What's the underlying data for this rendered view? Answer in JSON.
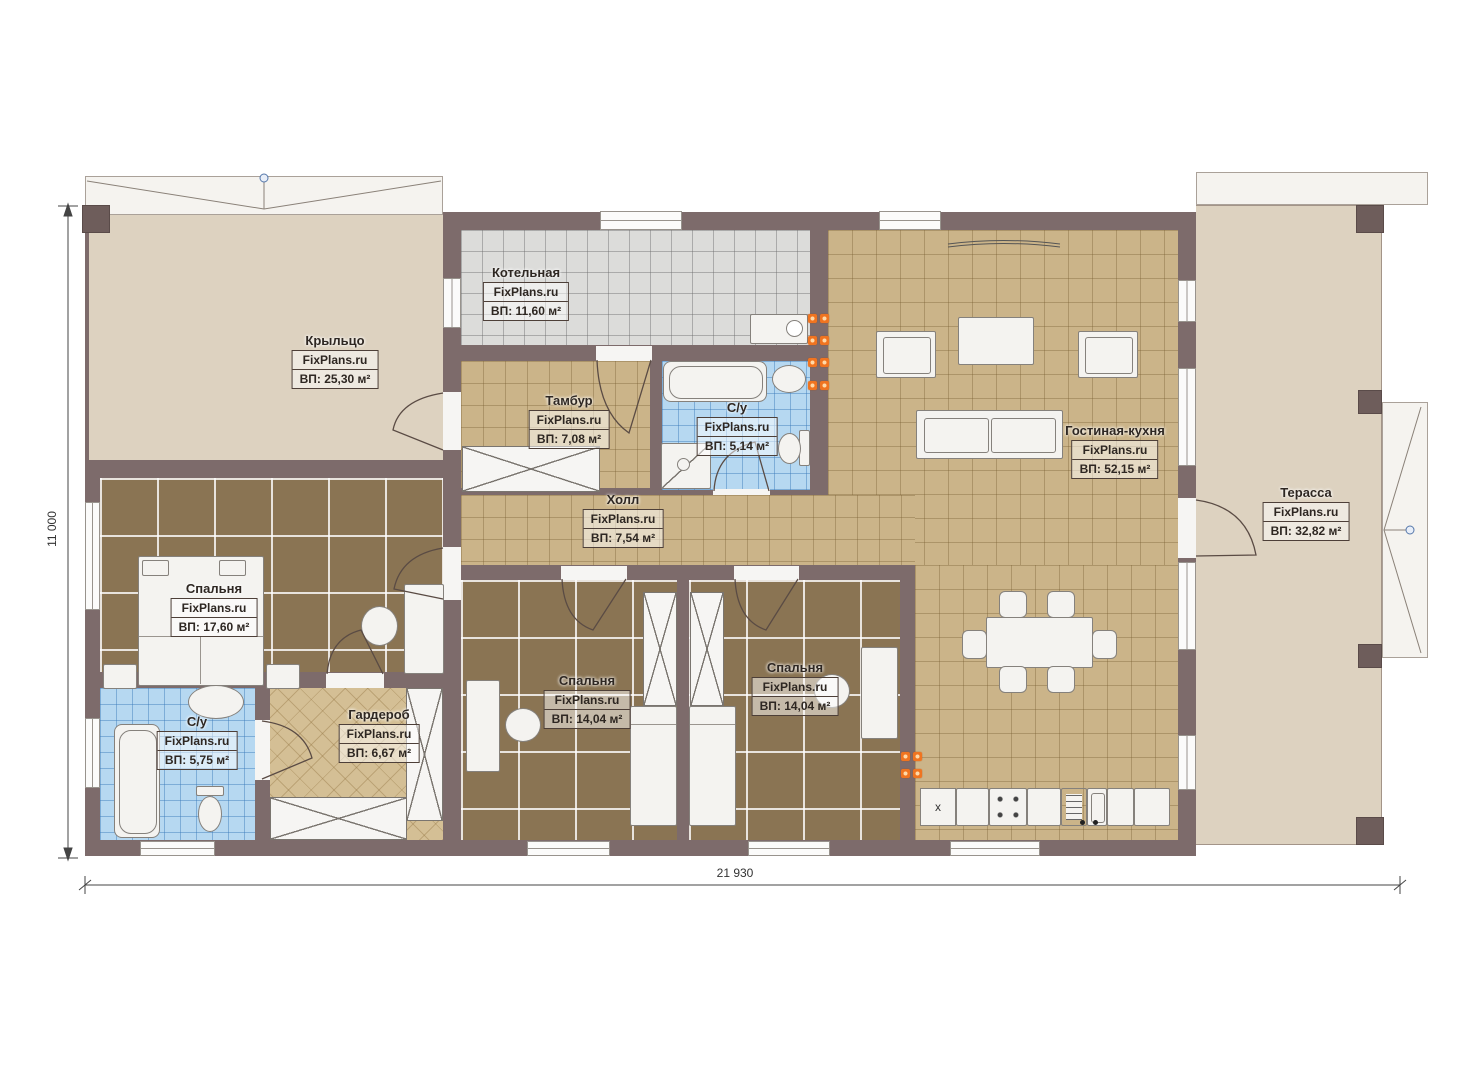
{
  "brand": "FixPlans.ru",
  "dimensions": {
    "width": "21 930",
    "height": "11 000"
  },
  "rooms": [
    {
      "id": "porch",
      "name": "Крыльцо",
      "area": "ВП: 25,30 м²"
    },
    {
      "id": "boiler",
      "name": "Котельная",
      "area": "ВП: 11,60 м²"
    },
    {
      "id": "tambour",
      "name": "Тамбур",
      "area": "ВП: 7,08 м²"
    },
    {
      "id": "su-top",
      "name": "С/у",
      "area": "ВП: 5,14 м²"
    },
    {
      "id": "hall",
      "name": "Холл",
      "area": "ВП: 7,54 м²"
    },
    {
      "id": "living",
      "name": "Гостиная-кухня",
      "area": "ВП: 52,15 м²"
    },
    {
      "id": "terrace",
      "name": "Терасса",
      "area": "ВП: 32,82 м²"
    },
    {
      "id": "bedroom-left",
      "name": "Спальня",
      "area": "ВП: 17,60 м²"
    },
    {
      "id": "su-bottom",
      "name": "С/у",
      "area": "ВП: 5,75 м²"
    },
    {
      "id": "wardrobe",
      "name": "Гардероб",
      "area": "ВП: 6,67 м²"
    },
    {
      "id": "bedroom-mid",
      "name": "Спальня",
      "area": "ВП: 14,04 м²"
    },
    {
      "id": "bedroom-right",
      "name": "Спальня",
      "area": "ВП: 14,04 м²"
    }
  ],
  "kitchen": {
    "cabinet_mark": "x"
  },
  "colors": {
    "wall": "#7d6b6b",
    "outdoor_floor": "#ddd2c0",
    "tile_tan": "#cbb489",
    "tile_brown": "#8a7453",
    "tile_blue": "#b6d8f1",
    "tile_gray": "#dcdcda",
    "wardrobe_floor": "#d4bf95",
    "radiator_orange": "#f07420"
  }
}
